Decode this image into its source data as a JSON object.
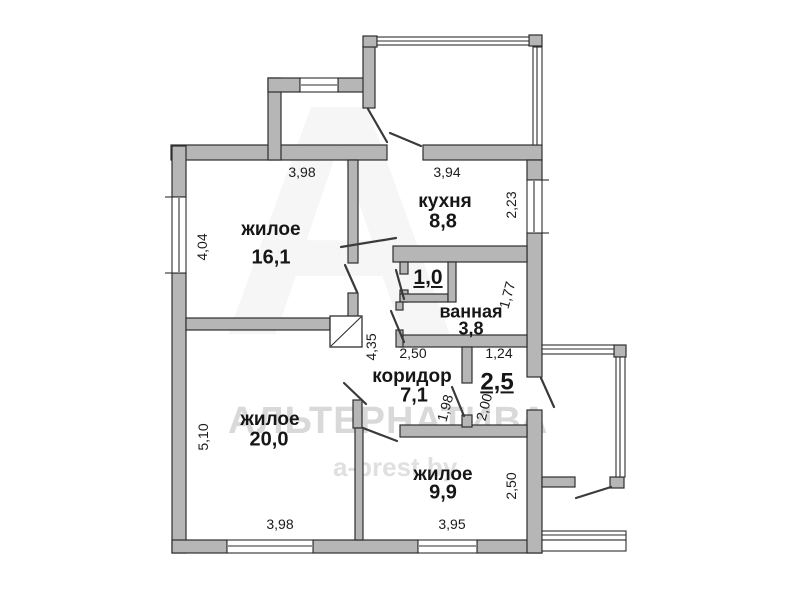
{
  "plan": {
    "rooms": [
      {
        "key": "living1",
        "name": "жилое",
        "area": "16,1"
      },
      {
        "key": "kitchen",
        "name": "кухня",
        "area": "8,8"
      },
      {
        "key": "wc",
        "name": "",
        "area": "1,0"
      },
      {
        "key": "bathroom",
        "name": "ванная",
        "area": "3,8"
      },
      {
        "key": "corridor",
        "name": "коридор",
        "area": "7,1"
      },
      {
        "key": "pantry",
        "name": "",
        "area": "2,5"
      },
      {
        "key": "living2",
        "name": "жилое",
        "area": "20,0"
      },
      {
        "key": "living3",
        "name": "жилое",
        "area": "9,9"
      }
    ],
    "dimensions": {
      "top_left": "3,98",
      "top_right": "3,94",
      "left_upper": "4,04",
      "kitchen_right": "2,23",
      "bath_right": "1,77",
      "hall_vertical": "4,35",
      "corridor_width": "2,50",
      "pantry_width": "1,24",
      "corridor_height": "1,98",
      "pantry_height": "2,00",
      "left_lower": "5,10",
      "living3_right": "2,50",
      "bottom_left": "3,98",
      "bottom_right": "3,95"
    },
    "watermark": {
      "brand": "АЛЬТЕРНАТИВА",
      "site": "a-brest.by",
      "logo_letter": "А"
    },
    "colors": {
      "wall_fill": "#b6b6b6",
      "wall_stroke": "#2e2e2e",
      "label_color": "#161616",
      "watermark_color": "#d9d9d9"
    }
  }
}
